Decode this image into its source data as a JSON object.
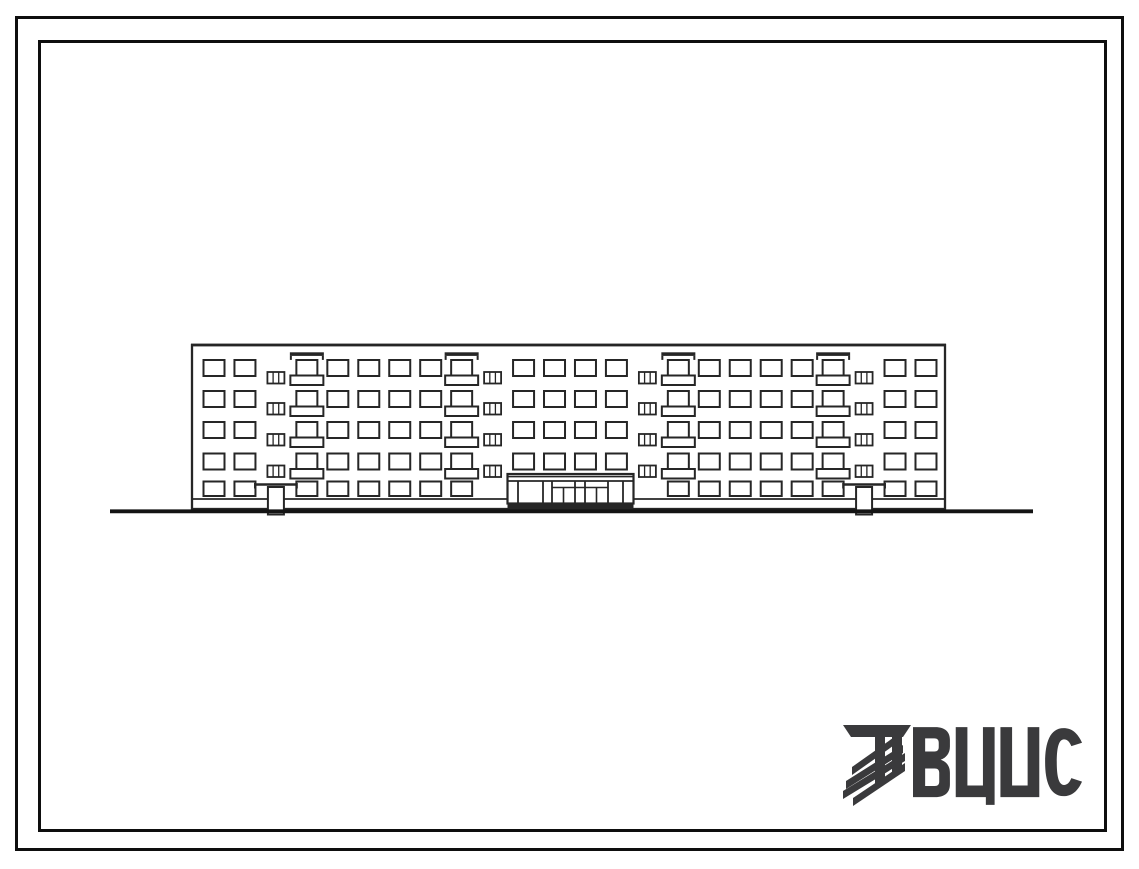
{
  "colors": {
    "ink": "#262626",
    "frame": "#0e0e0e",
    "paper": "#ffffff",
    "logo": "#3a3a3c"
  },
  "logo": {
    "text": "ВЦИС",
    "letters": [
      "В",
      "Ц",
      "И",
      "С"
    ],
    "emblem_icon": "hatched-column-emblem"
  },
  "elevation": {
    "description_visible_content": "front elevation of a five-storey panel apartment building",
    "floors": 5,
    "column_sequence": [
      "window",
      "window",
      "stair",
      "balcony",
      "window",
      "window",
      "window",
      "window",
      "balcony",
      "stair",
      "window",
      "window",
      "window",
      "window",
      "stair",
      "balcony",
      "window",
      "window",
      "window",
      "window",
      "balcony",
      "stair",
      "window",
      "window"
    ],
    "balcony_stacks": 4,
    "balcony_floors_per_stack": 4,
    "stair_columns": [
      3,
      10,
      15,
      22
    ],
    "stair_windows_per_column": 4,
    "roof_canopy_marks_over_columns": [
      4,
      9,
      16,
      21
    ],
    "porch_entrance_columns": [
      3,
      22
    ],
    "main_entrance": {
      "door_pairs": 2,
      "glazed_side_panels": 2,
      "span_columns": [
        11,
        14
      ],
      "dark_base_plinth": true
    },
    "ground_line": {
      "present": true
    }
  }
}
